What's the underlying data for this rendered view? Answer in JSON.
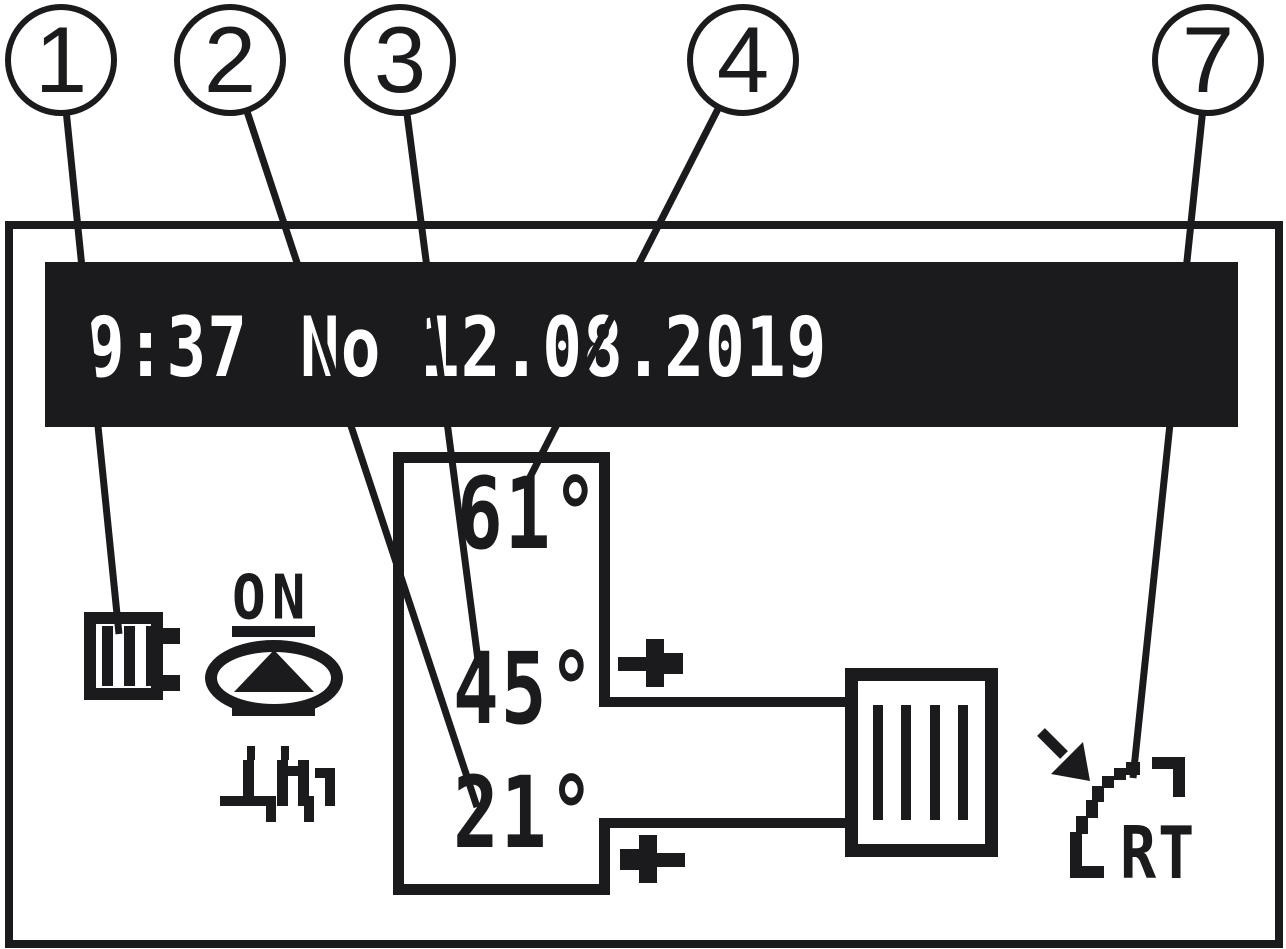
{
  "figure": {
    "type": "controller-display-diagram",
    "callouts": {
      "items": [
        {
          "number": "1"
        },
        {
          "number": "2"
        },
        {
          "number": "3"
        },
        {
          "number": "4"
        },
        {
          "number": "7"
        }
      ]
    },
    "display": {
      "statusbar": {
        "time": "9:37",
        "day": "No",
        "date": "12.08.2019"
      },
      "boiler_panel": {
        "temp_top": "61°",
        "temp_middle": "45°",
        "temp_bottom": "21°"
      },
      "pump": {
        "label": "ON"
      },
      "room_thermostat": {
        "label": "RT"
      },
      "icons": [
        "boiler-icon",
        "pump-icon",
        "heater-icon",
        "supply-arrow-icon",
        "return-arrow-icon",
        "radiator-icon",
        "room-thermostat-icon",
        "signal-arrow-icon"
      ],
      "colors": {
        "ink": "#1b1b1d",
        "statusbar_background": "#1b1b1d",
        "statusbar_text": "#ffffff",
        "background": "#ffffff"
      }
    }
  }
}
